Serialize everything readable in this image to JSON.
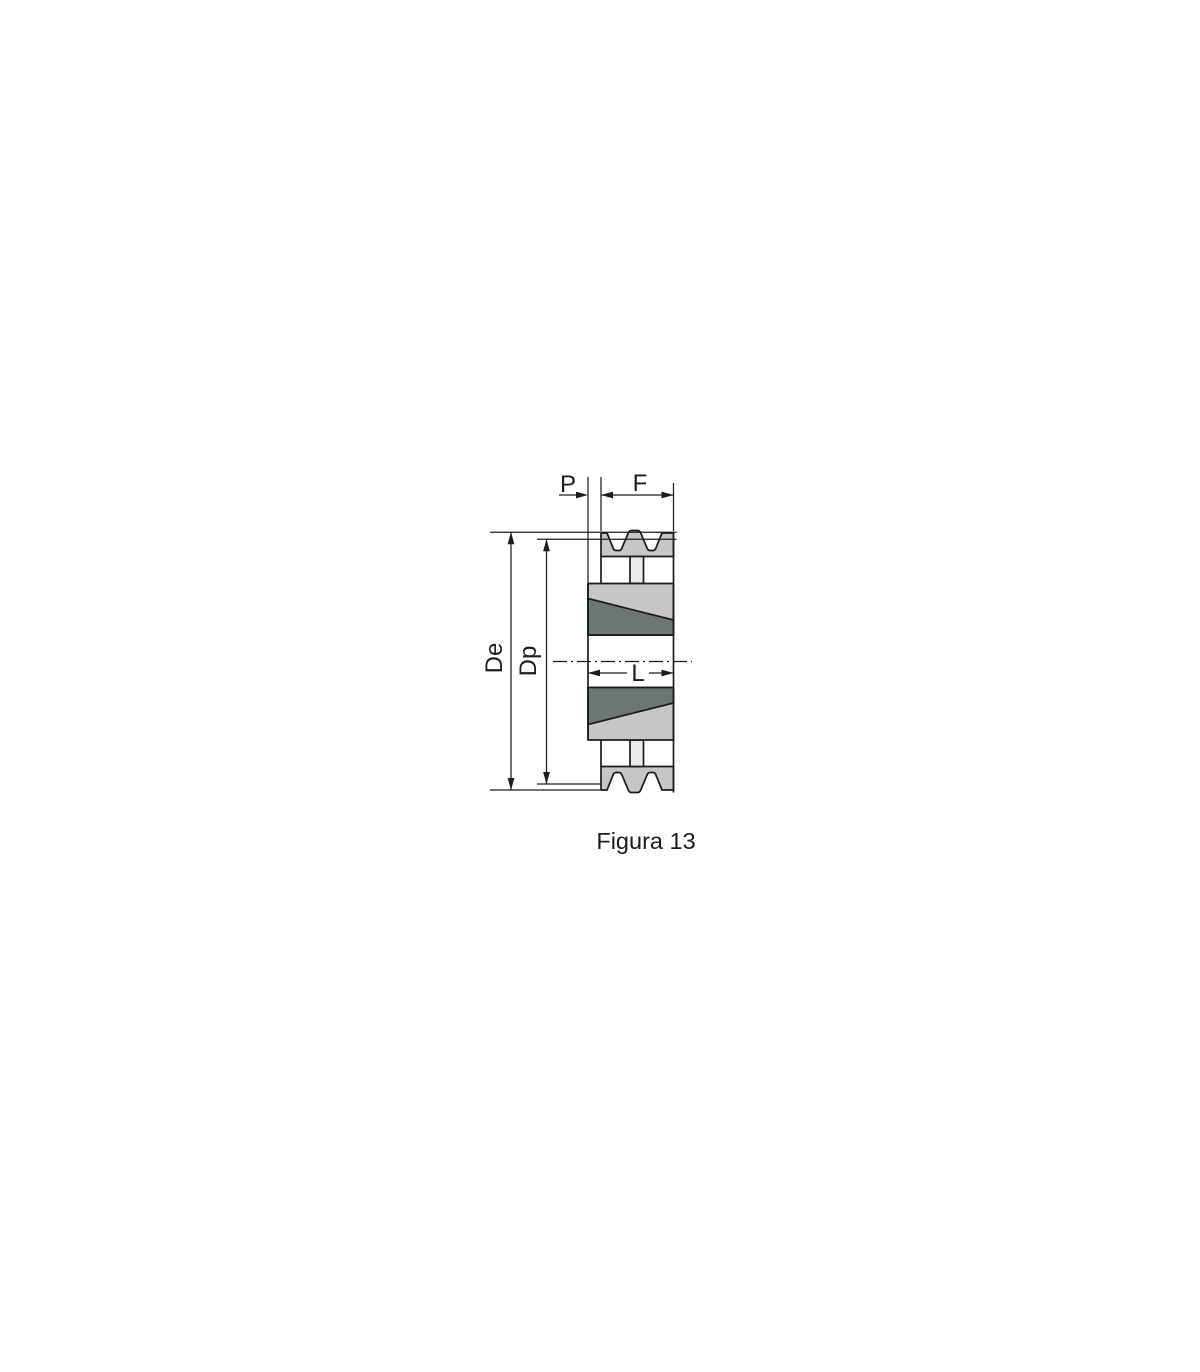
{
  "figure": {
    "caption": "Figura 13"
  },
  "labels": {
    "bush_protrusion": "P",
    "face_width": "F",
    "outer_diameter": "De",
    "pitch_diameter": "Dp",
    "hub_length": "L"
  },
  "colors": {
    "line": "#1c1c1c",
    "metal-light": "#c5c7c6",
    "bush-dark": "#6e7674",
    "plate-light": "#e9eae9"
  }
}
